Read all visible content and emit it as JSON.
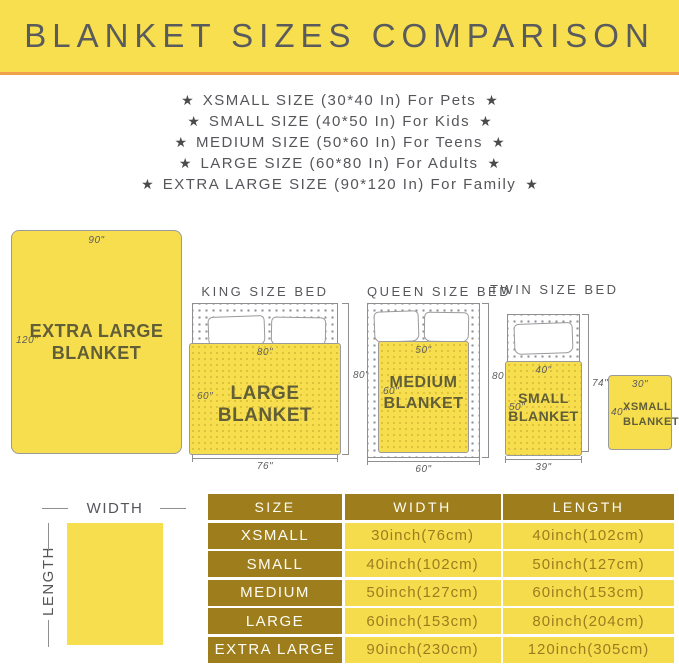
{
  "header": {
    "title": "BLANKET SIZES COMPARISON"
  },
  "star_glyph": "★",
  "size_list": [
    "XSMALL SIZE (30*40 In) For Pets",
    "SMALL SIZE (40*50 In) For Kids",
    "MEDIUM SIZE (50*60 In) For Teens",
    "LARGE SIZE (60*80 In) For Adults",
    "EXTRA LARGE SIZE (90*120 In) For Family"
  ],
  "colors": {
    "banner_yellow": "#F8DF4F",
    "accent_orange": "#F0A14C",
    "blanket_yellow": "#F6DE4E",
    "table_gold": "#9E7D1C",
    "cell_yellow": "#F5DC4D",
    "text_gray": "#56575A"
  },
  "diagram": {
    "xl": {
      "line1": "EXTRA LARGE",
      "line2": "BLANKET",
      "width_label": "90\"",
      "length_label": "120\""
    },
    "king": {
      "bed_title": "KING SIZE BED",
      "blanket_name": "LARGE BLANKET",
      "blanket_width": "80\"",
      "blanket_length": "60\"",
      "bed_height": "80\"",
      "bed_width": "76\""
    },
    "queen": {
      "bed_title": "QUEEN SIZE BED",
      "blanket_line1": "MEDIUM",
      "blanket_line2": "BLANKET",
      "blanket_width": "50\"",
      "blanket_length": "60\"",
      "bed_height": "80\"",
      "bed_width": "60\""
    },
    "twin": {
      "bed_title": "TWIN SIZE BED",
      "blanket_line1": "SMALL",
      "blanket_line2": "BLANKET",
      "blanket_width": "40\"",
      "blanket_length": "50\"",
      "bed_height": "74\"",
      "bed_width": "39\""
    },
    "xsmall": {
      "line1": "XSMALL",
      "line2": "BLANKET",
      "width_label": "30\"",
      "length_label": "40\""
    },
    "legend": {
      "width": "WIDTH",
      "length": "LENGTH"
    }
  },
  "table": {
    "headers": [
      "SIZE",
      "WIDTH",
      "LENGTH"
    ],
    "rows": [
      {
        "size": "XSMALL",
        "width": "30inch(76cm)",
        "length": "40inch(102cm)"
      },
      {
        "size": "SMALL",
        "width": "40inch(102cm)",
        "length": "50inch(127cm)"
      },
      {
        "size": "MEDIUM",
        "width": "50inch(127cm)",
        "length": "60inch(153cm)"
      },
      {
        "size": "LARGE",
        "width": "60inch(153cm)",
        "length": "80inch(204cm)"
      },
      {
        "size": "EXTRA LARGE",
        "width": "90inch(230cm)",
        "length": "120inch(305cm)"
      }
    ]
  }
}
